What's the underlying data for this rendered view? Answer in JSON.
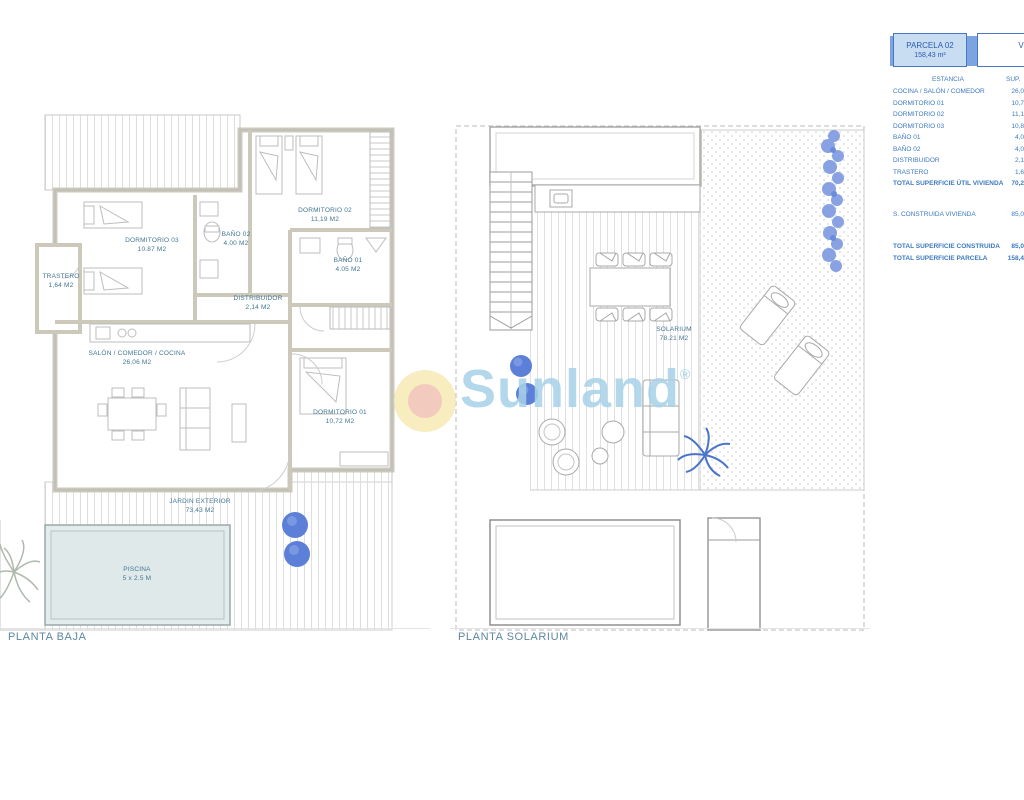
{
  "watermark": {
    "brand": "Sunland",
    "registered": "®"
  },
  "plan_baja": {
    "title": "PLANTA BAJA",
    "rooms": [
      {
        "name": "TRASTERO",
        "area": "1,64 M2"
      },
      {
        "name": "DORMITORIO 03",
        "area": "10.87 M2"
      },
      {
        "name": "BAÑO 02",
        "area": "4.00 M2"
      },
      {
        "name": "DORMITORIO 02",
        "area": "11,19 M2"
      },
      {
        "name": "BAÑO 01",
        "area": "4.05 M2"
      },
      {
        "name": "DISTRIBUIDOR",
        "area": "2,14 M2"
      },
      {
        "name": "SALÓN / COMEDOR / COCINA",
        "area": "26,06 M2"
      },
      {
        "name": "DORMITORIO 01",
        "area": "10,72 M2"
      },
      {
        "name": "JARDIN EXTERIOR",
        "area": "73,43 M2"
      },
      {
        "name": "PISCINA",
        "area": "5 x 2.5 M"
      }
    ]
  },
  "plan_solarium": {
    "title": "PLANTA SOLARIUM",
    "rooms": [
      {
        "name": "SOLARIUM",
        "area": "78.21 M2"
      }
    ]
  },
  "header_table": {
    "parcela": {
      "label": "PARCELA 02",
      "value": "158,43 m²"
    },
    "vivienda": {
      "label": "VIVIENDA",
      "value": "85.00"
    },
    "columns": {
      "estancia": "ESTANCIA",
      "sup": "SUP."
    },
    "rows": [
      {
        "label": "COCINA / SALÓN / COMEDOR",
        "value": "26,0"
      },
      {
        "label": "DORMITORIO 01",
        "value": "10,7"
      },
      {
        "label": "DORMITORIO 02",
        "value": "11,1"
      },
      {
        "label": "DORMITORIO 03",
        "value": "10,8"
      },
      {
        "label": "BAÑO 01",
        "value": "4,0"
      },
      {
        "label": "BAÑO 02",
        "value": "4,0"
      },
      {
        "label": "DISTRIBUIDOR",
        "value": "2,1"
      },
      {
        "label": "TRASTERO",
        "value": "1,6"
      }
    ],
    "total_util": {
      "label": "TOTAL SUPERFICIE ÚTIL VIVIENDA",
      "value": "70,2"
    },
    "construida": {
      "label": "S. CONSTRUIDA VIVIENDA",
      "value": "85,0"
    },
    "total_construida": {
      "label": "TOTAL SUPERFICIE CONSTRUIDA",
      "value": "85,0"
    },
    "total_parcela": {
      "label": "TOTAL SUPERFICIE PARCELA",
      "value": "158,4"
    }
  },
  "colors": {
    "table_text": "#3b79c2",
    "header_fill": "#c8dcf2",
    "header_bar": "#7da3e0",
    "header_border": "#4a76c8",
    "room_label": "#417693",
    "watermark_text": "#a8d2e8",
    "watermark_circle_outer": "#f6e9b0",
    "watermark_circle_inner": "#eeb9ae",
    "bush_blue": "#5c80d8",
    "hedge_blue": "#7d98e0",
    "pool_fill": "#e2ecec",
    "wall_beige": "#ccc8ba"
  }
}
